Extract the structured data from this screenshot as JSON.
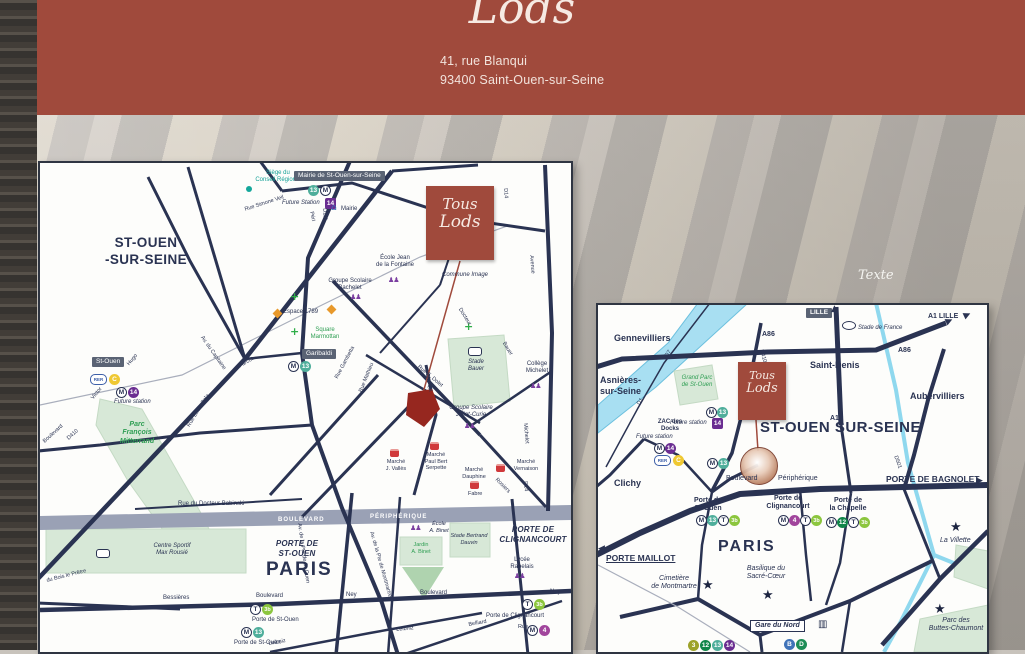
{
  "header": {
    "logo_top": "Tous",
    "logo_bottom": "Lods",
    "address": "41, rue Blanqui\n93400 Saint-Ouen-sur-Seine"
  },
  "background": {
    "placeholder": "Texte"
  },
  "colors": {
    "header_red": "#A04A3C",
    "map_navy": "#2A3352",
    "building_red": "#96271F",
    "teal": "#14A79B",
    "park_green": "#D7E8D7",
    "river_blue": "#A8DFF2",
    "periph_gray": "#9AA1B5"
  },
  "icons": {
    "m": "M",
    "l13": "13",
    "l14": "14",
    "l4": "4",
    "l12": "12",
    "l3": "3",
    "t": "T",
    "t3b": "3b",
    "rer": "RER",
    "c": "C",
    "b": "B",
    "d": "D",
    "star": "★",
    "plus": "+",
    "house": "⌂",
    "school": "♟♟",
    "train": "▥",
    "arrow_right": "▶",
    "arrow_left": "◀",
    "arrow_up": "▲"
  },
  "logo_square": {
    "line1": "Tous",
    "line2": "Lods"
  },
  "left_map": {
    "region": "ST-OUEN\n-SUR-SEINE",
    "conseil": "Siège du\nConseil Régional",
    "mairie_tag": "Mairie de St-Ouen-sur-Seine",
    "future_station": "Future Station",
    "mairie": "Mairie",
    "bachelet": "Groupe Scolaire\nBachelet",
    "fontaine": "École Jean\nde la Fontaine",
    "espace": "Espace 1789",
    "commune": "Commune Image",
    "marmottan": "Square\nMarmottan",
    "garibaldi": "Garibaldi",
    "stade_bauer": "Stade\nBauer",
    "michelet_college": "Collège\nMichelet",
    "joliot": "Groupe Scolaire\nJoliot-Curie",
    "st_ouen_station": "St-Ouen",
    "future_station2": "Future station",
    "parc_fm": "Parc\nFrançois\nMitterrand",
    "babinski": "Rue du Docteur Babinski",
    "blvd_band": "BOULEVARD",
    "periph_band": "PÉRIPHÉRIQUE",
    "porte_st_ouen": "PORTE DE\nST-OUEN",
    "paris": "PARIS",
    "porte_clignancourt": "PORTE DE\nCLIGNANCOURT",
    "max_rousie": "Centre Sportif\nMax Rousié",
    "bessieres": "Bessières",
    "boulevard1": "Boulevard",
    "ney1": "Ney",
    "boulevard2": "Boulevard",
    "ney2": "Ney",
    "pso_tram": "Porte de St-Ouen",
    "pso_metro": "Porte de St-Ouen",
    "pclig": "Porte de Clignancourt",
    "leibniz1": "Leibniz",
    "leibniz2": "Leibniz",
    "rue1": "Rue",
    "belliard": "Belliard",
    "fabre": "Fabre",
    "ecole_binet": "École\nA. Binet",
    "jardin_binet": "Jardin\nA. Binet",
    "dauvin": "Stade Bertrand\nDauvin",
    "rabelais": "Lycée\nRabelais",
    "mk_valles": "Marché\nJ. Vallès",
    "mk_paulbert": "Marché\nPaul Bert\nSerpette",
    "mk_dauphine": "Marché\nDauphine",
    "mk_vernaison": "Marché\nVernaison",
    "roads": {
      "victor": "Victor",
      "hugo": "Hugo",
      "d410": "D410",
      "boulevard_sw": "Boulevard",
      "zola": "Rue Emile Zola",
      "capitaine": "Av. du Capitaine",
      "farcot": "Farcot",
      "peri": "Péri",
      "d111": "D111",
      "simone": "Rue Simone Veil",
      "gambetta": "Rue Gambetta",
      "mathieu": "Rue Mathieu",
      "dolet": "Rue E. Dolet",
      "blanqui": "Blanqui",
      "docteur": "Docteur",
      "bauer": "Bauer",
      "michelet": "Michelet",
      "d14a": "D14",
      "d14b": "D14",
      "avenue": "Avenue",
      "rosiers": "Rosiers",
      "av_pso": "Av. de la Pte de St-Ouen",
      "av_mont": "Av. de la Pte de Montmartre",
      "bois": "du Bois le Prêtre"
    }
  },
  "right_map": {
    "gennevilliers": "Gennevilliers",
    "asnieres": "Asnières-\nsur-Seine",
    "clichy": "Clichy",
    "saint_denis": "Saint-Denis",
    "aubervilliers": "Aubervilliers",
    "st_ouen_big": "ST-OUEN SUR-SEINE",
    "paris": "PARIS",
    "porte_maillot": "PORTE MAILLOT",
    "porte_bagnolet": "PORTE DE BAGNOLET",
    "pso": "Porte de\nSt-Ouen",
    "pclig": "Porte de\nClignancourt",
    "pchap": "Porte de\nla Chapelle",
    "boulevard": "Boulevard",
    "peripherique": "Périphérique",
    "cimetiere": "Cimetière\nde Montmartre",
    "basilique": "Basilique du\nSacré-Cœur",
    "villette": "La Villette",
    "buttes": "Parc des\nButtes-Chaumont",
    "gare_du_nord": "Gare du Nord",
    "lille": "LILLE",
    "a1_lille": "A1 LILLE",
    "a86a": "A86",
    "a86b": "A86",
    "a1": "A1",
    "d410": "D410",
    "d7": "D7",
    "d1": "D1",
    "d501": "D501",
    "stade_france": "Stade de France",
    "grand_parc": "Grand Parc\nde St-Ouen",
    "zac": "ZAC des\nDocks",
    "future1": "Future station",
    "future2": "Future station"
  }
}
